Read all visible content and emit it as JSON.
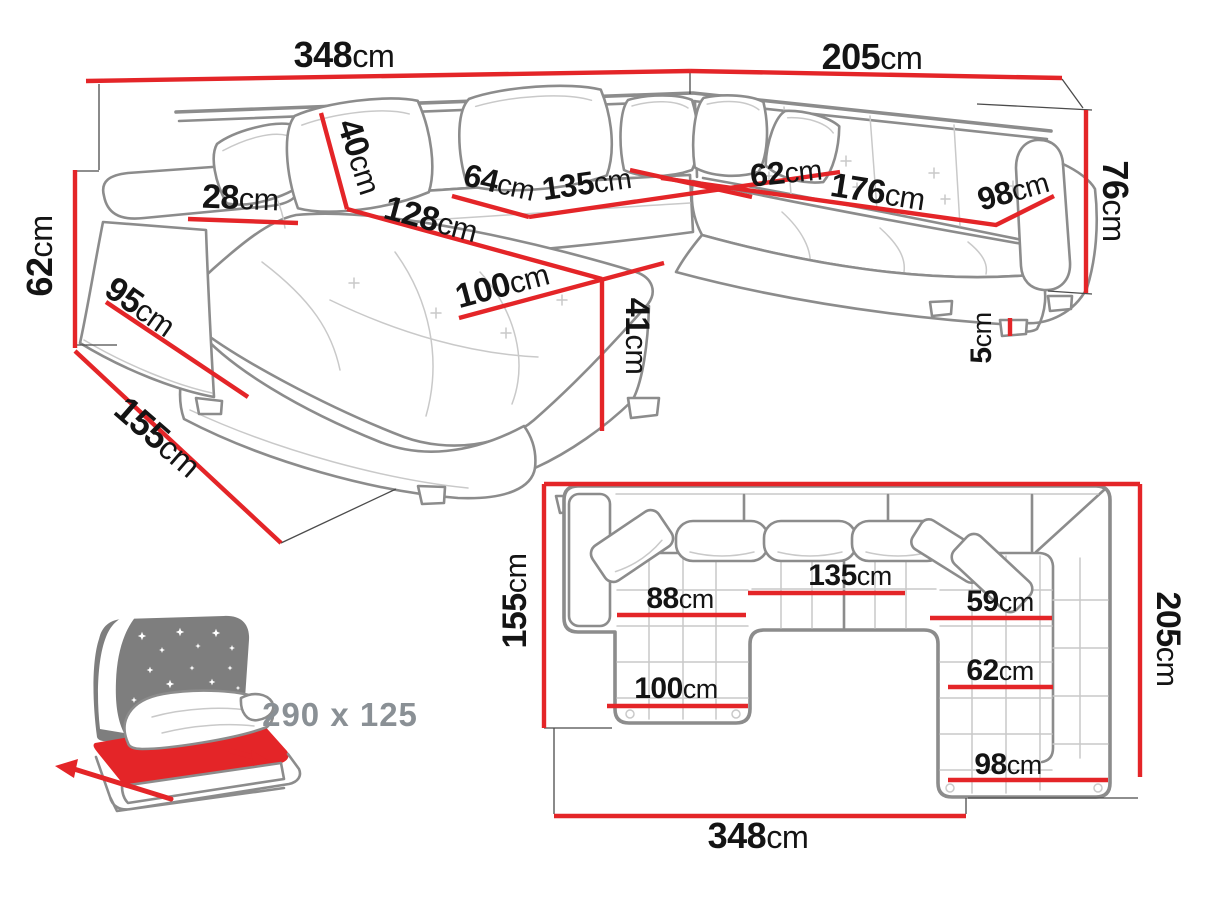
{
  "colors": {
    "dimension_red": "#e42528",
    "sofa_outline": "#8c8c8c",
    "sofa_detail": "#c9c9c9",
    "label_ink": "#141414",
    "muted_gray": "#8a9095",
    "icon_gray": "#7e7e7e",
    "background": "#ffffff"
  },
  "perspective_view": {
    "name": "sofa-3d-dimension-view",
    "measurements": [
      {
        "id": "back-width",
        "num": "348",
        "unit": "cm",
        "label": {
          "x": 344,
          "y": 67,
          "rot": 0,
          "size": 36
        },
        "line": [
          [
            86,
            81
          ],
          [
            690,
            71
          ]
        ]
      },
      {
        "id": "right-width",
        "num": "205",
        "unit": "cm",
        "label": {
          "x": 872,
          "y": 69,
          "rot": 0,
          "size": 36
        },
        "line": [
          [
            690,
            71
          ],
          [
            1062,
            78
          ]
        ]
      },
      {
        "id": "backrest-height",
        "num": "76",
        "unit": "cm",
        "label": {
          "x": 1103,
          "y": 201,
          "rot": 90,
          "size": 36
        },
        "line": [
          [
            1086,
            110
          ],
          [
            1086,
            293
          ]
        ]
      },
      {
        "id": "arm-height",
        "num": "62",
        "unit": "cm",
        "label": {
          "x": 52,
          "y": 256,
          "rot": -90,
          "size": 36
        },
        "line": [
          [
            75,
            170
          ],
          [
            75,
            348
          ]
        ]
      },
      {
        "id": "chaise-depth",
        "num": "155",
        "unit": "cm",
        "label": {
          "x": 150,
          "y": 446,
          "rot": 41,
          "size": 36
        },
        "line": [
          [
            75,
            351
          ],
          [
            281,
            543
          ]
        ]
      },
      {
        "id": "arm-front-depth",
        "num": "95",
        "unit": "cm",
        "label": {
          "x": 134,
          "y": 316,
          "rot": 35,
          "size": 34
        },
        "line": [
          [
            106,
            302
          ],
          [
            248,
            397
          ]
        ]
      },
      {
        "id": "armrest-width",
        "num": "28",
        "unit": "cm",
        "label": {
          "x": 240,
          "y": 209,
          "rot": 2,
          "size": 34
        },
        "line": [
          [
            188,
            219
          ],
          [
            298,
            223
          ]
        ]
      },
      {
        "id": "backrest-cushion-height",
        "num": "40",
        "unit": "cm",
        "label": {
          "x": 349,
          "y": 160,
          "rot": 72,
          "size": 34
        },
        "line": [
          [
            321,
            113
          ],
          [
            347,
            209
          ]
        ]
      },
      {
        "id": "chaise-length",
        "num": "128",
        "unit": "cm",
        "label": {
          "x": 428,
          "y": 230,
          "rot": 15,
          "size": 34
        },
        "line": [
          [
            347,
            209
          ],
          [
            602,
            279
          ]
        ]
      },
      {
        "id": "seat-depth-left",
        "num": "64",
        "unit": "cm",
        "label": {
          "x": 497,
          "y": 193,
          "rot": 13,
          "size": 32
        },
        "line": [
          [
            452,
            196
          ],
          [
            529,
            217
          ]
        ]
      },
      {
        "id": "seat-width-middle",
        "num": "135",
        "unit": "cm",
        "label": {
          "x": 588,
          "y": 194,
          "rot": -8,
          "size": 32
        },
        "line": [
          [
            529,
            217
          ],
          [
            840,
            172
          ]
        ]
      },
      {
        "id": "chaise-width",
        "num": "100",
        "unit": "cm",
        "label": {
          "x": 505,
          "y": 296,
          "rot": -15,
          "size": 34
        },
        "line": [
          [
            459,
            318
          ],
          [
            664,
            263
          ]
        ]
      },
      {
        "id": "seat-height",
        "num": "41",
        "unit": "cm",
        "label": {
          "x": 626,
          "y": 336,
          "rot": 90,
          "size": 34
        },
        "line": [
          [
            602,
            279
          ],
          [
            602,
            431
          ]
        ]
      },
      {
        "id": "seat-depth-right",
        "num": "62",
        "unit": "cm",
        "label": {
          "x": 787,
          "y": 183,
          "rot": -6,
          "size": 32
        },
        "line": [
          [
            630,
            170
          ],
          [
            752,
            197
          ]
        ]
      },
      {
        "id": "seat-width-right",
        "num": "176",
        "unit": "cm",
        "label": {
          "x": 876,
          "y": 203,
          "rot": 9,
          "size": 34
        },
        "line": [
          [
            661,
            178
          ],
          [
            996,
            225
          ],
          [
            1054,
            196
          ]
        ]
      },
      {
        "id": "seat-end-width",
        "num": "98",
        "unit": "cm",
        "label": {
          "x": 1016,
          "y": 201,
          "rot": -16,
          "size": 32
        }
      },
      {
        "id": "leg-height",
        "num": "5",
        "unit": "cm",
        "label": {
          "x": 991,
          "y": 338,
          "rot": -90,
          "size": 30
        },
        "line": [
          [
            1010,
            318
          ],
          [
            1010,
            336
          ]
        ]
      }
    ]
  },
  "plan_view": {
    "name": "sofa-top-dimension-view",
    "measurements": [
      {
        "id": "plan-frame-top",
        "line": [
          [
            544,
            484
          ],
          [
            1140,
            484
          ]
        ]
      },
      {
        "id": "plan-depth-left",
        "num": "155",
        "unit": "cm",
        "label": {
          "x": 526,
          "y": 601,
          "rot": -90,
          "size": 34
        },
        "line": [
          [
            544,
            484
          ],
          [
            544,
            728
          ]
        ]
      },
      {
        "id": "plan-depth-right",
        "num": "205",
        "unit": "cm",
        "label": {
          "x": 1157,
          "y": 639,
          "rot": 90,
          "size": 34
        },
        "line": [
          [
            1140,
            484
          ],
          [
            1140,
            777
          ]
        ]
      },
      {
        "id": "plan-total-width",
        "num": "348",
        "unit": "cm",
        "label": {
          "x": 758,
          "y": 848,
          "rot": 0,
          "size": 36
        },
        "line": [
          [
            554,
            816
          ],
          [
            966,
            816
          ]
        ]
      },
      {
        "id": "plan-left-seat-width",
        "num": "88",
        "unit": "cm",
        "label": {
          "x": 680,
          "y": 608,
          "rot": 0,
          "size": 30
        },
        "line": [
          [
            617,
            615
          ],
          [
            746,
            615
          ]
        ]
      },
      {
        "id": "plan-middle-seat-width",
        "num": "135",
        "unit": "cm",
        "label": {
          "x": 850,
          "y": 585,
          "rot": 0,
          "size": 30
        },
        "line": [
          [
            748,
            593
          ],
          [
            905,
            593
          ]
        ]
      },
      {
        "id": "plan-right-seat-width",
        "num": "59",
        "unit": "cm",
        "label": {
          "x": 1000,
          "y": 611,
          "rot": 0,
          "size": 30
        },
        "line": [
          [
            930,
            618
          ],
          [
            1052,
            618
          ]
        ]
      },
      {
        "id": "plan-chaise-width",
        "num": "100",
        "unit": "cm",
        "label": {
          "x": 676,
          "y": 698,
          "rot": 0,
          "size": 30
        },
        "line": [
          [
            607,
            706
          ],
          [
            748,
            706
          ]
        ]
      },
      {
        "id": "plan-right-inner-width",
        "num": "62",
        "unit": "cm",
        "label": {
          "x": 1000,
          "y": 680,
          "rot": 0,
          "size": 30
        },
        "line": [
          [
            948,
            687
          ],
          [
            1053,
            687
          ]
        ]
      },
      {
        "id": "plan-right-end-width",
        "num": "98",
        "unit": "cm",
        "label": {
          "x": 1008,
          "y": 774,
          "rot": 0,
          "size": 30
        },
        "line": [
          [
            948,
            780
          ],
          [
            1108,
            780
          ]
        ]
      }
    ]
  },
  "sleeping_function": {
    "size_label": "290 x 125"
  }
}
